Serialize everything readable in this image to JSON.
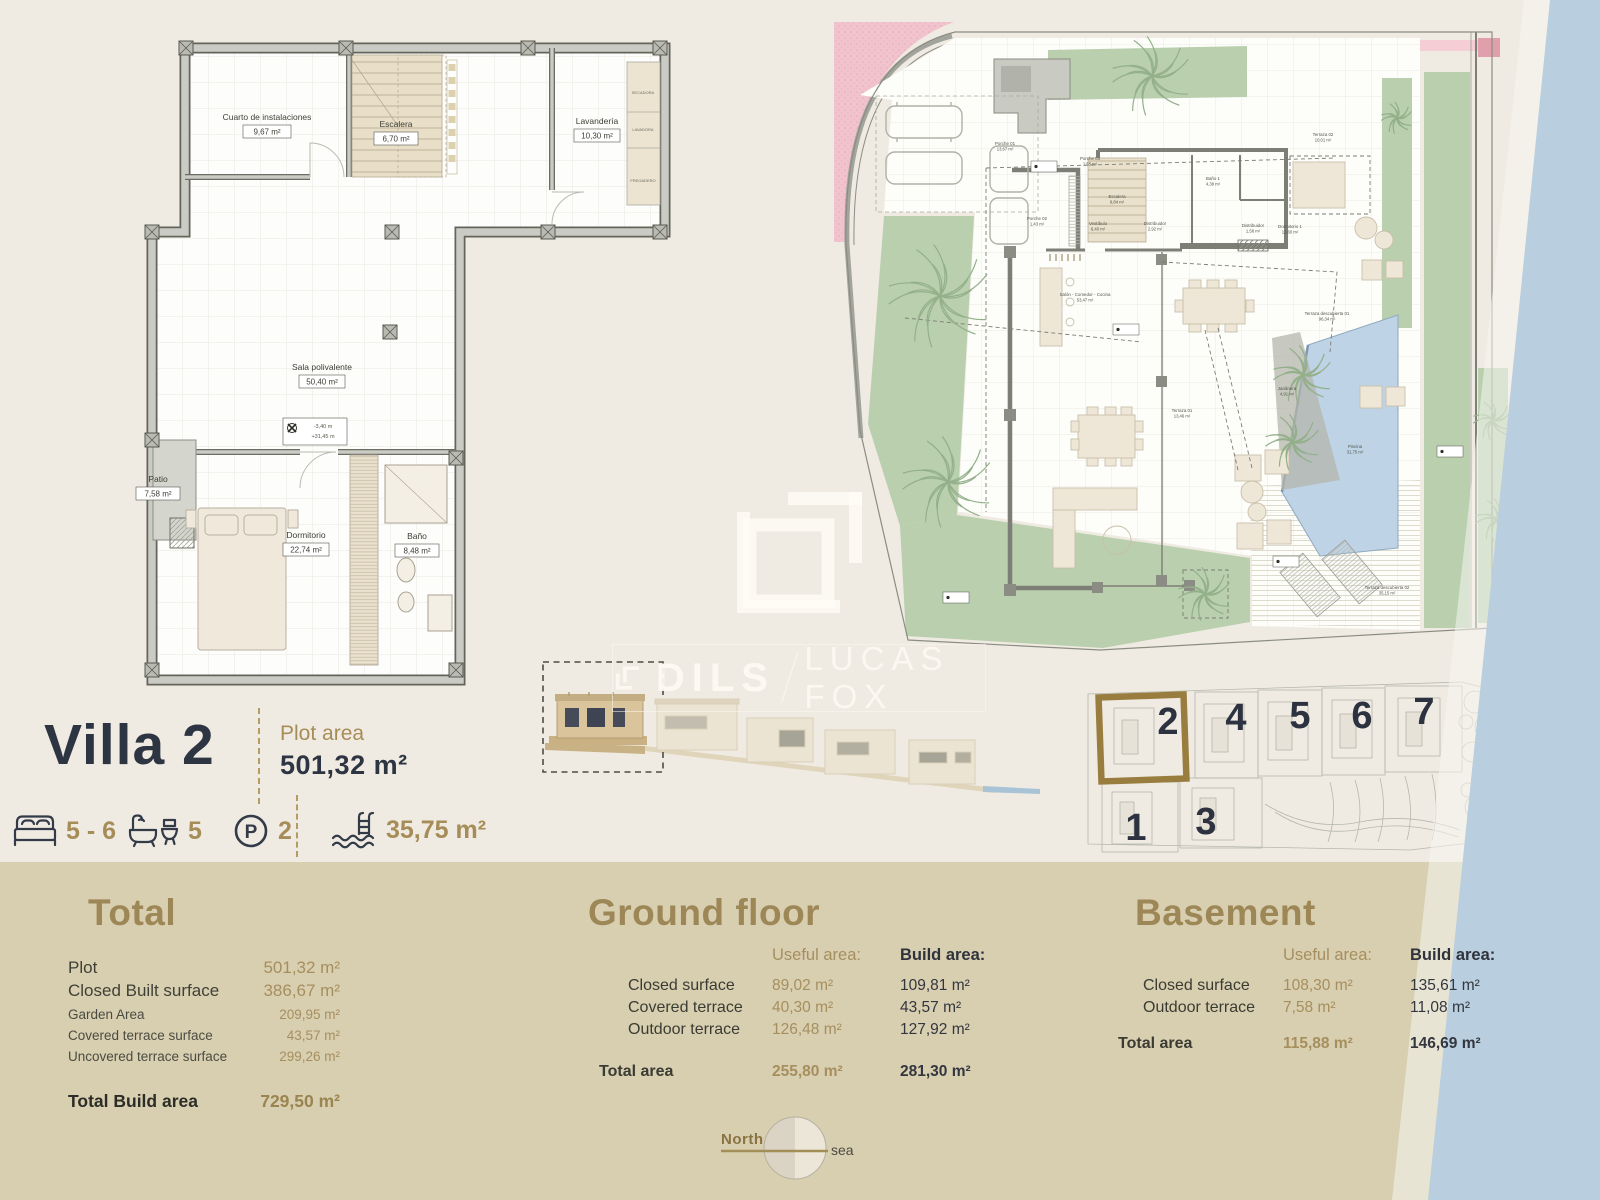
{
  "header": {
    "title": "Villa 2",
    "plot_label": "Plot area",
    "plot_value": "501,32  m²"
  },
  "features": {
    "beds": "5 - 6",
    "baths": "5",
    "parking": "2",
    "pool": "35,75 m²"
  },
  "watermark": {
    "brand_left": "DILS",
    "brand_right": "LUCAS FOX"
  },
  "compass": {
    "north": "North",
    "sea": "sea"
  },
  "colors": {
    "accent_gold": "#a68d58",
    "heading_gold": "#9d8756",
    "navy": "#2e3542",
    "band": "#d8ceb0",
    "sea": "#b9cede",
    "garden": "#b9cfae",
    "pool": "#bed3e5",
    "pink": "#f1c4cd"
  },
  "basement_plan": {
    "rooms": [
      {
        "name": "Cuarto de instalaciones",
        "area": "9,67 m²"
      },
      {
        "name": "Escalera",
        "area": "6,70 m²"
      },
      {
        "name": "Lavandería",
        "area": "10,30 m²"
      },
      {
        "name": "Sala polivalente",
        "area": "50,40 m²"
      },
      {
        "name": "Patio",
        "area": "7,58 m²"
      },
      {
        "name": "Dormitorio",
        "area": "22,74 m²"
      },
      {
        "name": "Baño",
        "area": "8,48 m²"
      }
    ],
    "appliances": [
      "SECADORA",
      "LAVADORA",
      "FREGADERO"
    ],
    "level_marker": {
      "line1": "-3,40 m",
      "line2": "+31,45 m"
    }
  },
  "ground_plan": {
    "rooms": [
      {
        "name": "Porche 01",
        "area": "13,67 m²"
      },
      {
        "name": "Porche 03",
        "area": "1,55 m²"
      },
      {
        "name": "Porche 02",
        "area": "1,43 m²"
      },
      {
        "name": "Escalera",
        "area": "9,84 m²"
      },
      {
        "name": "Baño 1",
        "area": "4,38 m²"
      },
      {
        "name": "Vestíbulo",
        "area": "6,40 m²"
      },
      {
        "name": "Distribuidor",
        "area": "2,92 m²"
      },
      {
        "name": "Distribuidor",
        "area": "1,58 m²"
      },
      {
        "name": "Dormitorio 1",
        "area": "13,60 m²"
      },
      {
        "name": "Terraza 02",
        "area": "10,01 m²"
      },
      {
        "name": "Salón - Comedor - Cocina",
        "area": "53,47 m²"
      },
      {
        "name": "Terraza 01",
        "area": "13,46 m²"
      },
      {
        "name": "Terraza descubierta 01",
        "area": "96,34 m²"
      },
      {
        "name": "Jardinera",
        "area": "4,91 m²"
      },
      {
        "name": "Piscina",
        "area": "31,75 m²"
      },
      {
        "name": "Terraza descubierta 02",
        "area": "35,15 m²"
      }
    ]
  },
  "site_plan": {
    "numbers": [
      "1",
      "2",
      "3",
      "4",
      "5",
      "6",
      "7"
    ],
    "highlighted": "2"
  },
  "sections": {
    "total": {
      "heading": "Total",
      "rows": [
        {
          "label": "Plot",
          "value": "501,32 m²"
        },
        {
          "label": "Closed Built surface",
          "value": "386,67 m²"
        }
      ],
      "small_rows": [
        {
          "label": "Garden Area",
          "value": "209,95 m²"
        },
        {
          "label": "Covered terrace surface",
          "value": "43,57  m²"
        },
        {
          "label": "Uncovered terrace surface",
          "value": "299,26 m²"
        }
      ],
      "total_row": {
        "label": "Total Build area",
        "value": "729,50 m²"
      }
    },
    "ground_floor": {
      "heading": "Ground floor",
      "col_useful": "Useful  area:",
      "col_build": "Build area:",
      "rows": [
        {
          "label": "Closed surface",
          "useful": "89,02 m²",
          "build": "109,81 m²"
        },
        {
          "label": "Covered terrace",
          "useful": "40,30 m²",
          "build": "43,57 m²"
        },
        {
          "label": "Outdoor terrace",
          "useful": "126,48 m²",
          "build": "127,92 m²"
        }
      ],
      "total_row": {
        "label": "Total area",
        "useful": "255,80 m²",
        "build": "281,30 m²"
      }
    },
    "basement": {
      "heading": "Basement",
      "col_useful": "Useful  area:",
      "col_build": "Build area:",
      "rows": [
        {
          "label": "Closed surface",
          "useful": "108,30 m²",
          "build": "135,61 m²"
        },
        {
          "label": "Outdoor terrace",
          "useful": "7,58 m²",
          "build": "11,08 m²"
        }
      ],
      "total_row": {
        "label": "Total area",
        "useful": "115,88 m²",
        "build": "146,69 m²"
      }
    }
  }
}
